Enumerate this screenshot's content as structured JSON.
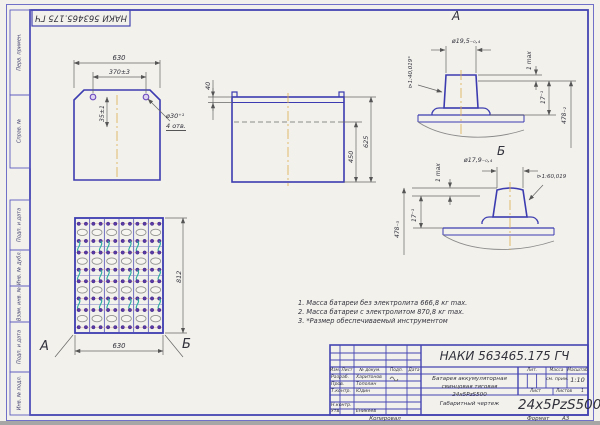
{
  "frame": {
    "stamp": "НАКИ 563465.175 ГЧ",
    "margin_labels": [
      "Перв. примен.",
      "Справ. №",
      "Подп. и дата",
      "Инв. № дубл.",
      "Взам. инв. №",
      "Подп. и дата",
      "Инв. № подл."
    ],
    "copied_label": "Копировал",
    "format_label": "Формат",
    "format_value": "А3"
  },
  "top_view": {
    "dim_width": "630",
    "dim_holes": "370±3",
    "dim_hole_offset": "35±1",
    "hole_dia": "ø30⁺¹",
    "hole_count": "4 отв."
  },
  "side_view": {
    "dim_lip": "40",
    "dim_level": "450",
    "dim_height": "625"
  },
  "plan_view": {
    "dim_height": "812",
    "dim_width": "630",
    "label_a": "А",
    "label_b": "Б",
    "grid": {
      "cols": 6,
      "rows": 4
    }
  },
  "detail_a": {
    "label": "А",
    "dia": "ø19,5₋₀‚₄",
    "gap": "1 max",
    "dim17": "17⁻¹",
    "dim478": "478₋₂",
    "taper": "⊳1:40,019°"
  },
  "detail_b": {
    "label": "Б",
    "dia": "ø17,9₋₀‚₄",
    "gap": "1 max",
    "dim17": "17⁻¹",
    "dim478": "478₋₃",
    "taper": "⊳1:60,019"
  },
  "notes": [
    "1. Масса батареи без электролита 666,8 кг max.",
    "2. Масса батареи с электролитом 870,8 кг max.",
    "3. *Размер обеспечиваемый инструментом"
  ],
  "title_block": {
    "designation": "НАКИ 563465.175 ГЧ",
    "title_lines": [
      "Батарея аккумуляторная",
      "свинцовая тяговая",
      "24х5PzS500",
      "Габаритный чертеж"
    ],
    "code": "24x5PzS500",
    "header": {
      "izm": "Изм.",
      "list": "Лист",
      "doc": "№ докум.",
      "sign": "Подп.",
      "date": "Дата"
    },
    "rows": [
      {
        "role": "Разраб.",
        "name": "Харитонов"
      },
      {
        "role": "Пров.",
        "name": "Тополин"
      },
      {
        "role": "Т.контр.",
        "name": "Юдин"
      },
      {
        "role": "Н.контр.",
        "name": ""
      },
      {
        "role": "Утв.",
        "name": "Еникеев"
      }
    ],
    "lit_label": "Лит.",
    "mass_label": "Масса",
    "scale_label": "Масштаб",
    "mass_value": "см. прим.",
    "scale_value": "1:10",
    "sheet_label": "Лист",
    "sheets_label": "Листов",
    "sheets_value": "1"
  },
  "colors": {
    "frame_blue": "#4545b2",
    "line_blue": "#3c3cb0",
    "dim_gray": "#666666",
    "center_orange": "#dfaf4e",
    "connector_teal": "#2aab9e",
    "terminal_purple": "#5b3aa8"
  }
}
